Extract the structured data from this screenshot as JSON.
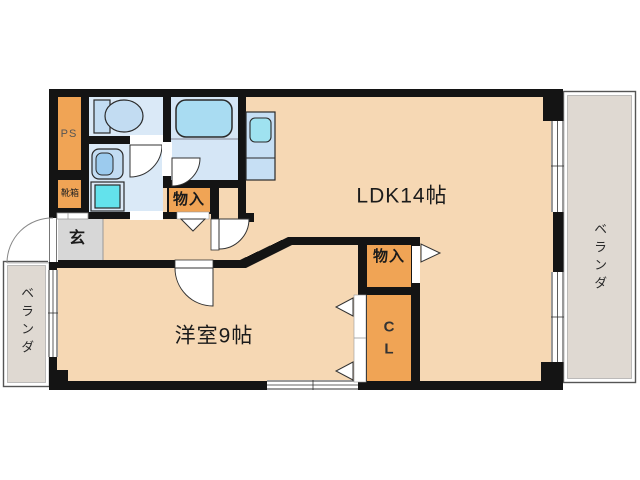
{
  "labels": {
    "ldk": "LDK14帖",
    "western_room": "洋室9帖",
    "storage_hall": "物入",
    "storage_ldk": "物入",
    "closet_line1": "C",
    "closet_line2": "L",
    "entrance": "玄",
    "pipe_space": "PS",
    "shoe_box": "靴箱",
    "veranda_left": "ベランダ",
    "veranda_right": "ベランダ"
  },
  "colors": {
    "floor_peach": "#F6D8B4",
    "storage_orange": "#F0A455",
    "wet_room_blue": "#DAE9F7",
    "fixture_blue": "#C2DCF2",
    "appliance_cyan": "#63E2EC",
    "entrance_gray": "#D7D7D7",
    "veranda_gray": "#DFD9D2",
    "wall_black": "#141414"
  }
}
